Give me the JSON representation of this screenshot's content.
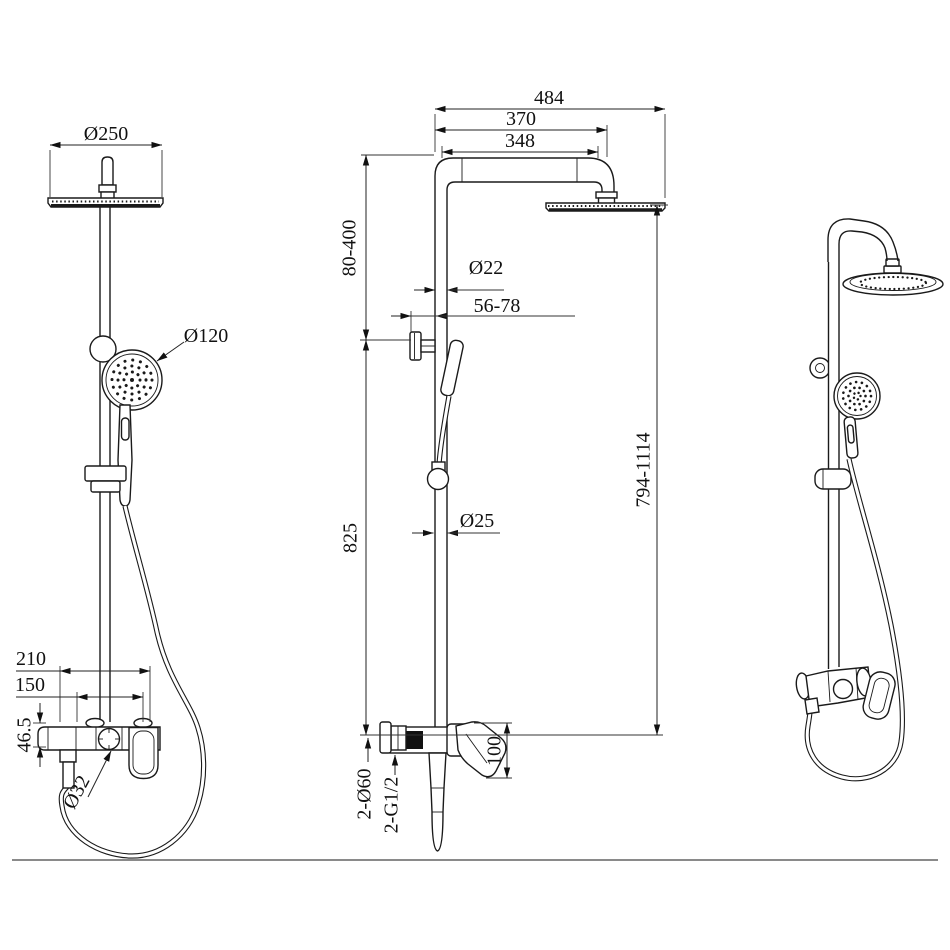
{
  "drawing": {
    "type": "shower-system-technical-drawing",
    "line_color": "#1a1a1a",
    "background": "#ffffff"
  },
  "dims": {
    "front": {
      "overhead_diameter": "Ø250",
      "hand_shower_diameter": "Ø120",
      "valve_width": "210",
      "inlet_spacing": "150",
      "valve_height": "46.5",
      "knob_diameter": "Ø32"
    },
    "side": {
      "overall_depth": "484",
      "arm_depth": "370",
      "arm_length": "348",
      "upper_pipe_range": "80-400",
      "upper_pipe_diameter": "Ø22",
      "wall_clearance": "56-78",
      "lower_pipe_length": "825",
      "lower_pipe_diameter": "Ø25",
      "overall_height_range": "794-1114",
      "handle_drop": "100",
      "escutcheons": "2-Ø60",
      "connections": "2-G1/2"
    }
  }
}
